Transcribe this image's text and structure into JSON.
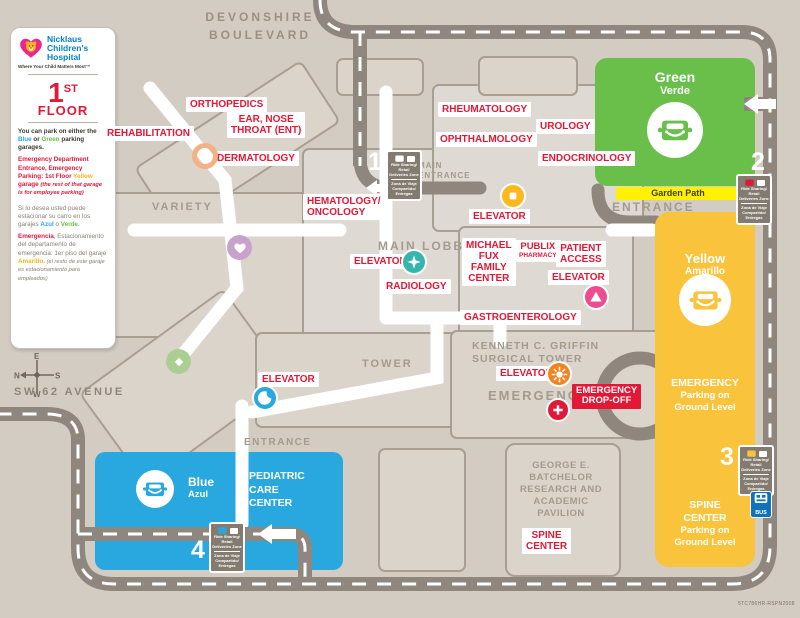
{
  "brand": {
    "line1": "Nicklaus",
    "line2": "Children's",
    "line3": "Hospital",
    "tagline": "Where Your Child Matters Most™"
  },
  "floor": {
    "number": "1",
    "suffix": "ST",
    "word": "FLOOR"
  },
  "legend": {
    "park_en": [
      "You can park on either the ",
      "Blue",
      " or ",
      "Green",
      " parking garages."
    ],
    "emerg_en": [
      "Emergency Department Entrance, Emergency Parking: 1st Floor ",
      "Yellow",
      " garage ",
      "(the rest of that garage is for employee parking)"
    ],
    "park_es": [
      "Si lo desea usted puede estacionar su carro en los garajes ",
      "Azul",
      " o ",
      "Verde."
    ],
    "emerg_es": [
      "Emergencia",
      ", Estacionamiento del departamento de emergencia: 1er piso del garaje ",
      "Amarillo.",
      " (el resto de este garaje es estacionamiento para empleados)"
    ]
  },
  "streets": {
    "devonshire1": "DEVONSHIRE",
    "devonshire2": "BOULEVARD",
    "sw62": "SW 62 AVENUE"
  },
  "compass": {
    "n": "N",
    "e": "E",
    "s": "S",
    "w": "W"
  },
  "areas": {
    "variety": "VARIETY",
    "main_lobby": "MAIN LOBBY",
    "tower": "TOWER",
    "main_entrance": [
      "MAIN",
      "ENTRANCE"
    ],
    "entrance": "ENTRANCE",
    "surgical_tower": [
      "KENNETH C. GRIFFIN",
      "SURGICAL TOWER"
    ],
    "emergency": "EMERGENCY",
    "batchelor": [
      "GEORGE E.",
      "BATCHELOR",
      "RESEARCH AND",
      "ACADEMIC",
      "PAVILION"
    ],
    "garden_path": "Garden Path"
  },
  "departments": {
    "orthopedics": "ORTHOPEDICS",
    "ent": [
      "EAR, NOSE",
      "THROAT (ENT)"
    ],
    "rehabilitation": "REHABILITATION",
    "dermatology": "DERMATOLOGY",
    "hematology": [
      "HEMATOLOGY/",
      "ONCOLOGY"
    ],
    "rheumatology": "RHEUMATOLOGY",
    "ophthalmology": "OPHTHALMOLOGY",
    "urology": "UROLOGY",
    "endocrinology": "ENDOCRINOLOGY",
    "elevator": "ELEVATOR",
    "radiology": "RADIOLOGY",
    "michael_fux": [
      "MICHAEL",
      "FUX",
      "FAMILY",
      "CENTER"
    ],
    "publix": [
      "PUBLIX",
      "PHARMACY"
    ],
    "patient_access": [
      "PATIENT",
      "ACCESS"
    ],
    "gastroenterology": "GASTROENTEROLOGY",
    "spine_center": [
      "SPINE",
      "CENTER"
    ],
    "emergency_drop_off": [
      "EMERGENCY",
      "DROP-OFF"
    ]
  },
  "garages": {
    "green": {
      "name": "Green",
      "name_es": "Verde"
    },
    "yellow": {
      "name": "Yellow",
      "name_es": "Amarillo",
      "note": [
        "EMERGENCY",
        "Parking on",
        "Ground Level"
      ],
      "spine": [
        "SPINE",
        "CENTER",
        "Parking on",
        "Ground Level"
      ]
    },
    "blue": {
      "name": "Blue",
      "name_es": "Azul",
      "center": [
        "PEDIATRIC",
        "CARE",
        "CENTER"
      ]
    }
  },
  "markers": {
    "m1": "1",
    "m2": "2",
    "m3": "3",
    "m4": "4",
    "sign_en": "Ride Sharing/ Retail Deliveries Zone",
    "sign_es": "Zona de Viaje Compartido/ Entregas",
    "bus": "BUS"
  },
  "colors": {
    "red": "#e31837",
    "green": "#6abf4b",
    "yellow_garage": "#f9c33c",
    "blue": "#29a8e0",
    "teal": "#35b5ad",
    "pink": "#ed4d8c",
    "orange": "#f58220",
    "elevator_yellow": "#fdb81e",
    "road": "#8f877d",
    "background": "#d3ccc3",
    "logo_pink": "#ec268f",
    "logo_blue": "#0082ca",
    "garden_path_yellow": "#fff100"
  },
  "footer": {
    "code": "5TC786HR-RSPN2008"
  }
}
